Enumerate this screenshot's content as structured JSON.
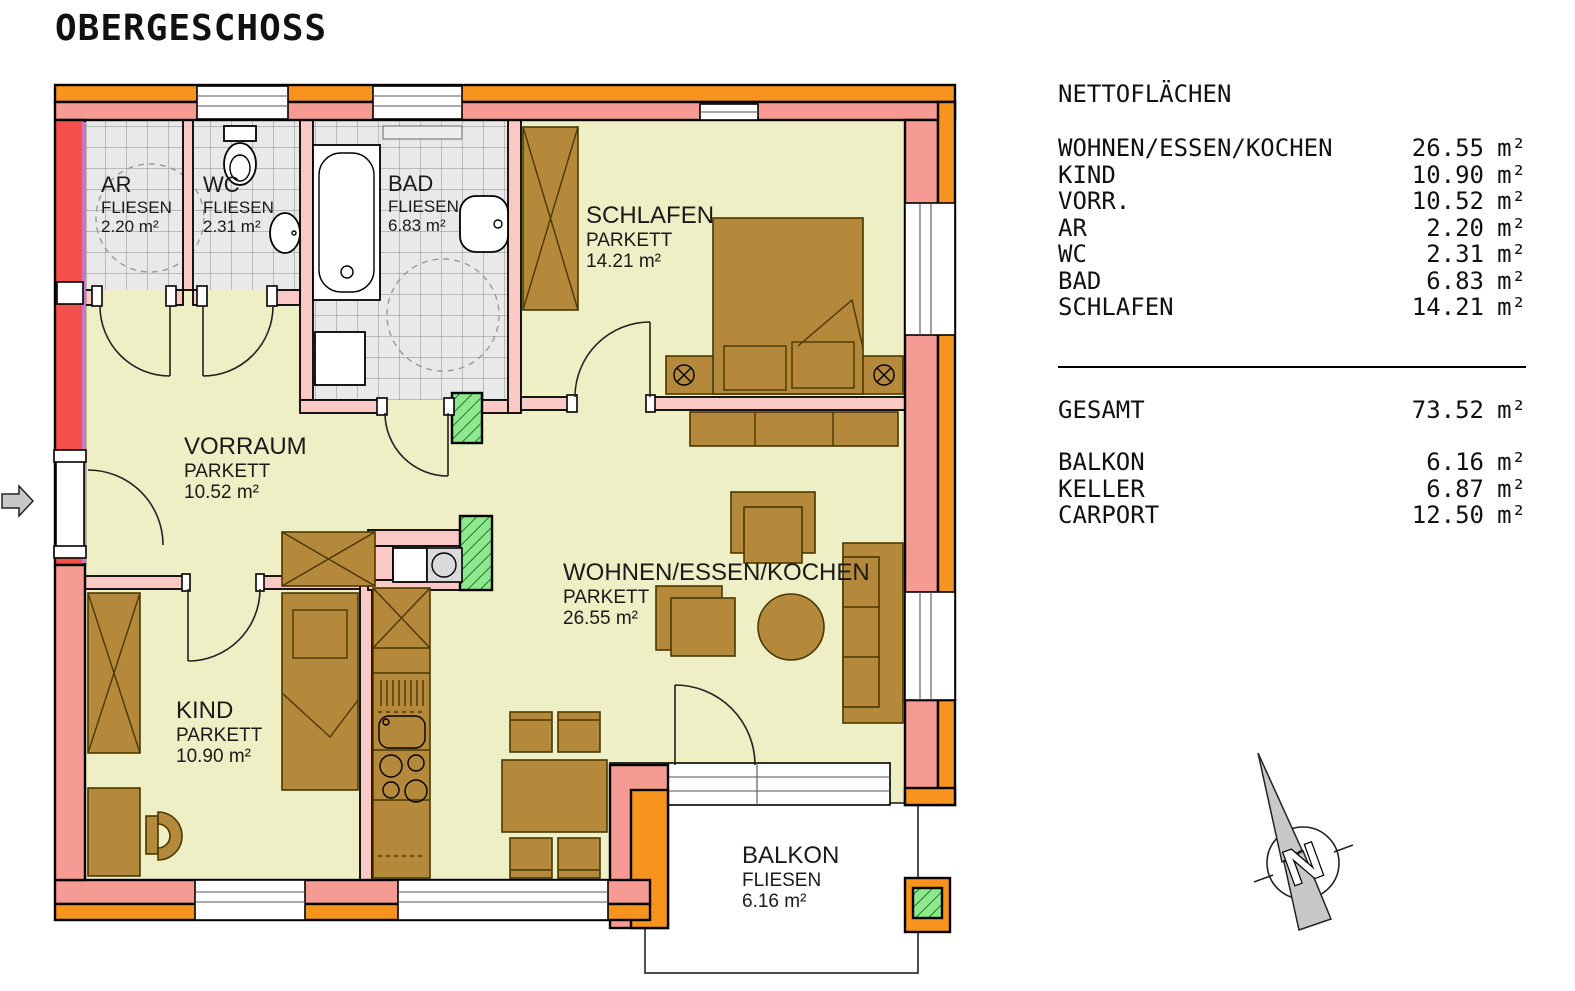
{
  "title": "OBERGESCHOSS",
  "netto_table": {
    "heading": "NETTOFLÄCHEN",
    "rows": [
      {
        "label": "WOHNEN/ESSEN/KOCHEN",
        "value": "26.55",
        "unit": "m²"
      },
      {
        "label": "KIND",
        "value": "10.90",
        "unit": "m²"
      },
      {
        "label": "VORR.",
        "value": "10.52",
        "unit": "m²"
      },
      {
        "label": "AR",
        "value": "2.20",
        "unit": "m²"
      },
      {
        "label": "WC",
        "value": "2.31",
        "unit": "m²"
      },
      {
        "label": "BAD",
        "value": "6.83",
        "unit": "m²"
      },
      {
        "label": "SCHLAFEN",
        "value": "14.21",
        "unit": "m²"
      }
    ],
    "total": {
      "label": "GESAMT",
      "value": "73.52",
      "unit": "m²"
    },
    "extras": [
      {
        "label": "BALKON",
        "value": "6.16",
        "unit": "m²"
      },
      {
        "label": "KELLER",
        "value": "6.87",
        "unit": "m²"
      },
      {
        "label": "CARPORT",
        "value": "12.50",
        "unit": "m²"
      }
    ]
  },
  "rooms": {
    "ar": {
      "name": "AR",
      "floor": "FLIESEN",
      "area": "2.20 m²"
    },
    "wc": {
      "name": "WC",
      "floor": "FLIESEN",
      "area": "2.31 m²"
    },
    "bad": {
      "name": "BAD",
      "floor": "FLIESEN",
      "area": "6.83 m²"
    },
    "schlafen": {
      "name": "SCHLAFEN",
      "floor": "PARKETT",
      "area": "14.21 m²"
    },
    "vorraum": {
      "name": "VORRAUM",
      "floor": "PARKETT",
      "area": "10.52 m²"
    },
    "wohnen": {
      "name": "WOHNEN/ESSEN/KOCHEN",
      "floor": "PARKETT",
      "area": "26.55 m²"
    },
    "kind": {
      "name": "KIND",
      "floor": "PARKETT",
      "area": "10.90 m²"
    },
    "balkon": {
      "name": "BALKON",
      "floor": "FLIESEN",
      "area": "6.16 m²"
    }
  },
  "compass": {
    "label": "N"
  },
  "colors": {
    "orange": "#F7941E",
    "salmon": "#F59B93",
    "pink": "#FAC9C5",
    "red": "#F4514E",
    "lilac": "#C878C8",
    "parkett": "#EFEFC6",
    "wood": "#B5893C",
    "green": "#8FE88F",
    "gray": "#C8C8C8"
  }
}
